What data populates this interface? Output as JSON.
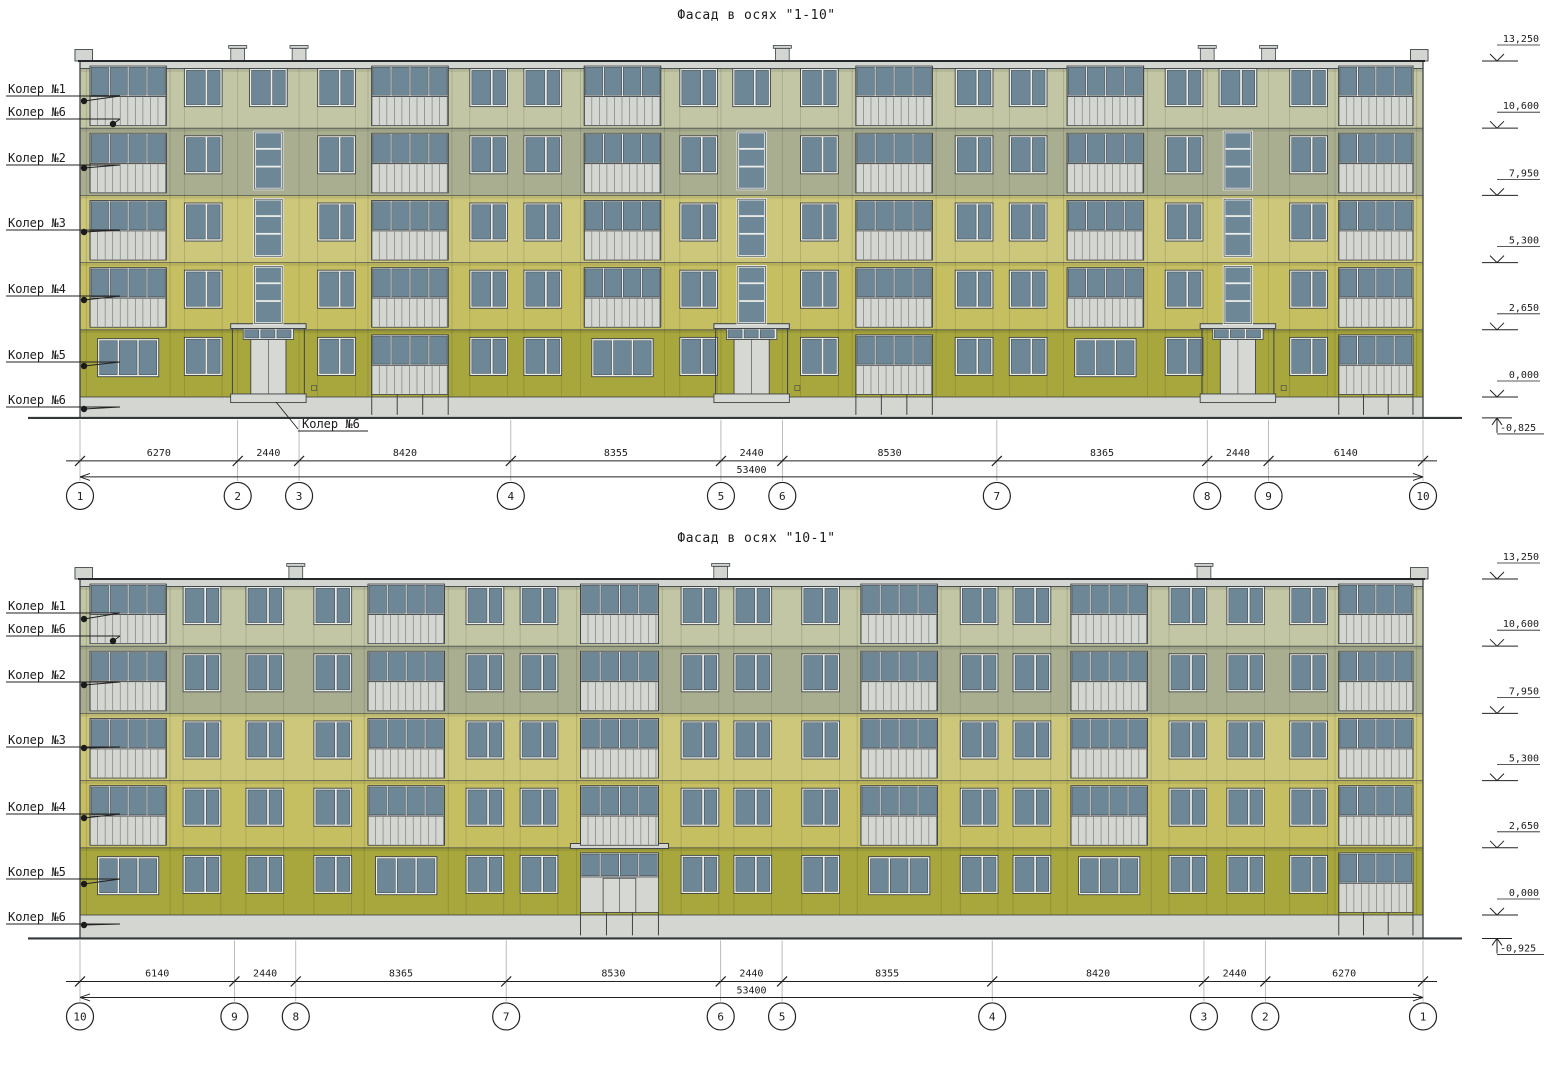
{
  "colors": {
    "koler1": "#c2c6a4",
    "koler2": "#aaae90",
    "koler3": "#cdc77b",
    "koler4": "#c6bf62",
    "koler5": "#a7a73d",
    "koler6": "#d4d6d1",
    "window": "#6e8797",
    "frame": "#eceee9",
    "outline": "#3d4347",
    "parapet": "#d2d5d0",
    "door": "#d6d8d3",
    "dimline": "#222222",
    "extline": "#9aa0a3",
    "groundline": "#33383b"
  },
  "facades": [
    {
      "id": "1-10",
      "title": "Фасад в осях \"1-10\"",
      "origin": {
        "x": 80,
        "y0": 397
      },
      "scale": {
        "kx": 0.02515,
        "ky": 0.02536
      },
      "length_mm": 53400,
      "base_depth": 825,
      "bands": [
        {
          "color": "koler1",
          "from": 10600,
          "to": 12950
        },
        {
          "color": "koler2",
          "from": 7950,
          "to": 10600
        },
        {
          "color": "koler3",
          "from": 5300,
          "to": 7950
        },
        {
          "color": "koler4",
          "from": 2650,
          "to": 5300
        },
        {
          "color": "koler5",
          "from": 0,
          "to": 2650
        }
      ],
      "elevations": [
        {
          "label": "13,250",
          "mm": 13250
        },
        {
          "label": "10,600",
          "mm": 10600
        },
        {
          "label": "7,950",
          "mm": 7950
        },
        {
          "label": "5,300",
          "mm": 5300
        },
        {
          "label": "2,650",
          "mm": 2650
        },
        {
          "label": "0,000",
          "mm": 0
        }
      ],
      "foundation_mark": {
        "label": "-0,825",
        "mm": -825
      },
      "color_labels": [
        {
          "text": "Колер №1",
          "y": 93,
          "dot": [
            84,
            101
          ]
        },
        {
          "text": "Колер №6",
          "y": 116,
          "dot": [
            113,
            124
          ]
        },
        {
          "text": "Колер №2",
          "y": 162,
          "dot": [
            84,
            168
          ]
        },
        {
          "text": "Колер №3",
          "y": 227,
          "dot": [
            84,
            232
          ]
        },
        {
          "text": "Колер №4",
          "y": 293,
          "dot": [
            84,
            300
          ]
        },
        {
          "text": "Колер №5",
          "y": 359,
          "dot": [
            84,
            366
          ]
        },
        {
          "text": "Колер №6",
          "y": 404,
          "dot": [
            84,
            409
          ]
        }
      ],
      "annotation": {
        "text": "Колер №6",
        "tx": 302,
        "ty": 428,
        "underline": [
          298,
          431,
          368,
          431
        ],
        "leader": [
          [
            298,
            429
          ],
          [
            276,
            402
          ]
        ]
      },
      "dims": [
        {
          "label": "6270",
          "mm": 6270
        },
        {
          "label": "2440",
          "mm": 2440
        },
        {
          "label": "8420",
          "mm": 8420
        },
        {
          "label": "8355",
          "mm": 8355
        },
        {
          "label": "2440",
          "mm": 2440
        },
        {
          "label": "8530",
          "mm": 8530
        },
        {
          "label": "8365",
          "mm": 8365
        },
        {
          "label": "2440",
          "mm": 2440
        },
        {
          "label": "6140",
          "mm": 6140
        }
      ],
      "total": {
        "label": "53400"
      },
      "axes": [
        "1",
        "2",
        "3",
        "4",
        "5",
        "6",
        "7",
        "8",
        "9",
        "10"
      ],
      "vents_mm": [
        6270,
        8710,
        27925,
        44820,
        47260
      ],
      "stacks": [
        {
          "t": "loggia",
          "x": 250,
          "w": 3330,
          "g": "triple"
        },
        {
          "t": "pair",
          "x": 4150,
          "w": 1500
        },
        {
          "t": "stair",
          "x": 6270,
          "w": 2440
        },
        {
          "t": "pair",
          "x": 9450,
          "w": 1500
        },
        {
          "t": "loggia",
          "x": 11450,
          "w": 3340,
          "g": "loggia"
        },
        {
          "t": "pair",
          "x": 15500,
          "w": 1500
        },
        {
          "t": "pair",
          "x": 17650,
          "w": 1500
        },
        {
          "t": "loggia",
          "x": 19900,
          "w": 3340,
          "g": "triple"
        },
        {
          "t": "pair",
          "x": 23850,
          "w": 1500
        },
        {
          "t": "stair",
          "x": 25485,
          "w": 2440
        },
        {
          "t": "pair",
          "x": 28650,
          "w": 1500
        },
        {
          "t": "loggia",
          "x": 30700,
          "w": 3340,
          "g": "loggia"
        },
        {
          "t": "pair",
          "x": 34800,
          "w": 1500
        },
        {
          "t": "pair",
          "x": 36950,
          "w": 1500
        },
        {
          "t": "loggia",
          "x": 39100,
          "w": 3340,
          "g": "triple"
        },
        {
          "t": "pair",
          "x": 43150,
          "w": 1500
        },
        {
          "t": "stair",
          "x": 44820,
          "w": 2440
        },
        {
          "t": "pair",
          "x": 48100,
          "w": 1500
        },
        {
          "t": "loggia",
          "x": 49900,
          "w": 3250,
          "g": "loggia"
        }
      ]
    },
    {
      "id": "10-1",
      "title": "Фасад в осях \"10-1\"",
      "origin": {
        "x": 80,
        "y0": 915
      },
      "scale": {
        "kx": 0.02515,
        "ky": 0.02536
      },
      "length_mm": 53400,
      "base_depth": 925,
      "bands": [
        {
          "color": "koler1",
          "from": 10600,
          "to": 12950
        },
        {
          "color": "koler2",
          "from": 7950,
          "to": 10600
        },
        {
          "color": "koler3",
          "from": 5300,
          "to": 7950
        },
        {
          "color": "koler4",
          "from": 2650,
          "to": 5300
        },
        {
          "color": "koler5",
          "from": 0,
          "to": 2650
        }
      ],
      "elevations": [
        {
          "label": "13,250",
          "mm": 13250
        },
        {
          "label": "10,600",
          "mm": 10600
        },
        {
          "label": "7,950",
          "mm": 7950
        },
        {
          "label": "5,300",
          "mm": 5300
        },
        {
          "label": "2,650",
          "mm": 2650
        },
        {
          "label": "0,000",
          "mm": 0
        }
      ],
      "foundation_mark": {
        "label": "-0,925",
        "mm": -925
      },
      "color_labels": [
        {
          "text": "Колер №1",
          "y": 610,
          "dot": [
            84,
            619
          ]
        },
        {
          "text": "Колер №6",
          "y": 633,
          "dot": [
            113,
            641
          ]
        },
        {
          "text": "Колер №2",
          "y": 679,
          "dot": [
            84,
            685
          ]
        },
        {
          "text": "Колер №3",
          "y": 744,
          "dot": [
            84,
            748
          ]
        },
        {
          "text": "Колер №4",
          "y": 811,
          "dot": [
            84,
            818
          ]
        },
        {
          "text": "Колер №5",
          "y": 876,
          "dot": [
            84,
            884
          ]
        },
        {
          "text": "Колер №6",
          "y": 921,
          "dot": [
            84,
            925
          ]
        }
      ],
      "annotation": null,
      "dims": [
        {
          "label": "6140",
          "mm": 6140
        },
        {
          "label": "2440",
          "mm": 2440
        },
        {
          "label": "8365",
          "mm": 8365
        },
        {
          "label": "8530",
          "mm": 8530
        },
        {
          "label": "2440",
          "mm": 2440
        },
        {
          "label": "8355",
          "mm": 8355
        },
        {
          "label": "8420",
          "mm": 8420
        },
        {
          "label": "2440",
          "mm": 2440
        },
        {
          "label": "6270",
          "mm": 6270
        }
      ],
      "total": {
        "label": "53400"
      },
      "axes": [
        "10",
        "9",
        "8",
        "7",
        "6",
        "5",
        "4",
        "3",
        "2",
        "1"
      ],
      "vents_mm": [
        8580,
        25475,
        44690
      ],
      "stacks": [
        {
          "t": "loggia",
          "x": 250,
          "w": 3330,
          "g": "triple"
        },
        {
          "t": "pair",
          "x": 4100,
          "w": 1500
        },
        {
          "t": "pair",
          "x": 6600,
          "w": 1500
        },
        {
          "t": "pair",
          "x": 9300,
          "w": 1500
        },
        {
          "t": "loggia",
          "x": 11300,
          "w": 3340,
          "g": "triple"
        },
        {
          "t": "pair",
          "x": 15350,
          "w": 1500
        },
        {
          "t": "pair",
          "x": 17500,
          "w": 1500
        },
        {
          "t": "loggia",
          "x": 19750,
          "w": 3400,
          "g": "porch"
        },
        {
          "t": "pair",
          "x": 23900,
          "w": 1500
        },
        {
          "t": "pair",
          "x": 26000,
          "w": 1500
        },
        {
          "t": "pair",
          "x": 28700,
          "w": 1500
        },
        {
          "t": "loggia",
          "x": 30900,
          "w": 3340,
          "g": "triple"
        },
        {
          "t": "pair",
          "x": 35000,
          "w": 1500
        },
        {
          "t": "pair",
          "x": 37100,
          "w": 1500
        },
        {
          "t": "loggia",
          "x": 39250,
          "w": 3340,
          "g": "triple"
        },
        {
          "t": "pair",
          "x": 43300,
          "w": 1500
        },
        {
          "t": "pair",
          "x": 45600,
          "w": 1500
        },
        {
          "t": "pair",
          "x": 48100,
          "w": 1500
        },
        {
          "t": "loggia",
          "x": 49900,
          "w": 3250,
          "g": "loggia"
        }
      ]
    }
  ]
}
